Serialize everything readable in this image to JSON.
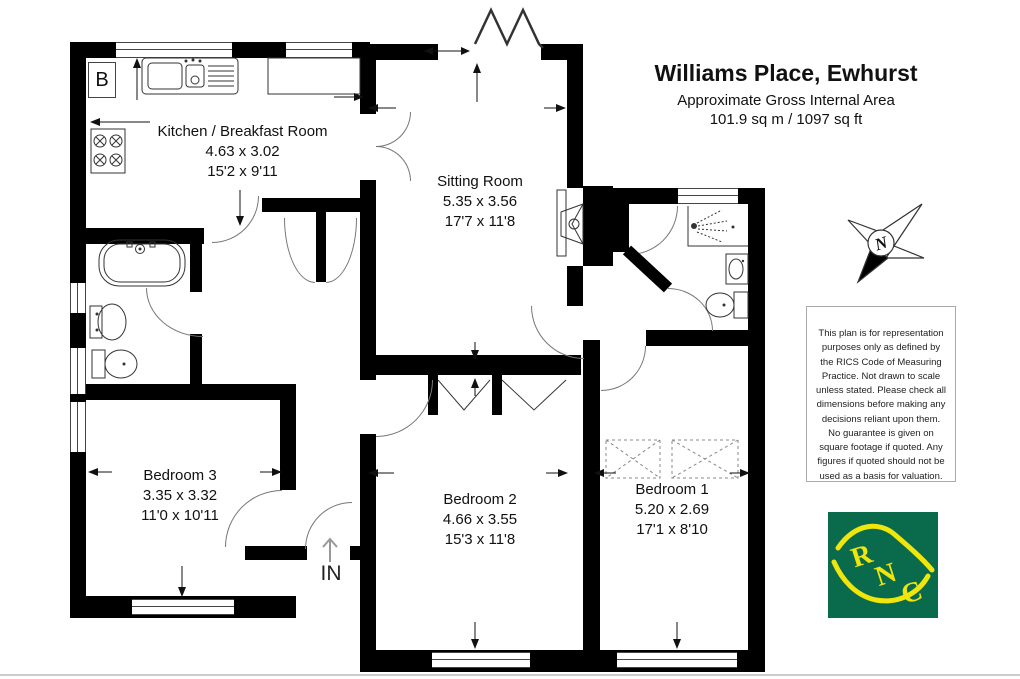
{
  "header": {
    "title": "Williams Place, Ewhurst",
    "subtitle": "Approximate Gross Internal Area",
    "area": "101.9 sq m / 1097 sq ft"
  },
  "rooms": [
    {
      "name": "Kitchen / Breakfast Room",
      "metric": "4.63 x 3.02",
      "imperial": "15'2 x 9'11"
    },
    {
      "name": "Sitting Room",
      "metric": "5.35 x 3.56",
      "imperial": "17'7 x 11'8"
    },
    {
      "name": "Bedroom 3",
      "metric": "3.35 x 3.32",
      "imperial": "11'0 x 10'11"
    },
    {
      "name": "Bedroom 2",
      "metric": "4.66 x 3.55",
      "imperial": "15'3 x 11'8"
    },
    {
      "name": "Bedroom 1",
      "metric": "5.20 x 2.69",
      "imperial": "17'1 x 8'10"
    }
  ],
  "labels": {
    "entrance": "IN",
    "boiler": "B",
    "compass_north": "N"
  },
  "disclaimer": "This plan is for representation purposes only as defined by the RICS Code of Measuring Practice. Not drawn to scale unless stated. Please check all dimensions before making any decisions reliant upon them. No guarantee is given on square footage if quoted. Any figures if quoted should not be used as a basis for valuation.",
  "logo": {
    "letters": [
      "R",
      "N",
      "C"
    ],
    "background": "#0a6b4c",
    "foreground": "#f0e60c"
  },
  "colors": {
    "wall": "#000000",
    "line": "#555555"
  }
}
